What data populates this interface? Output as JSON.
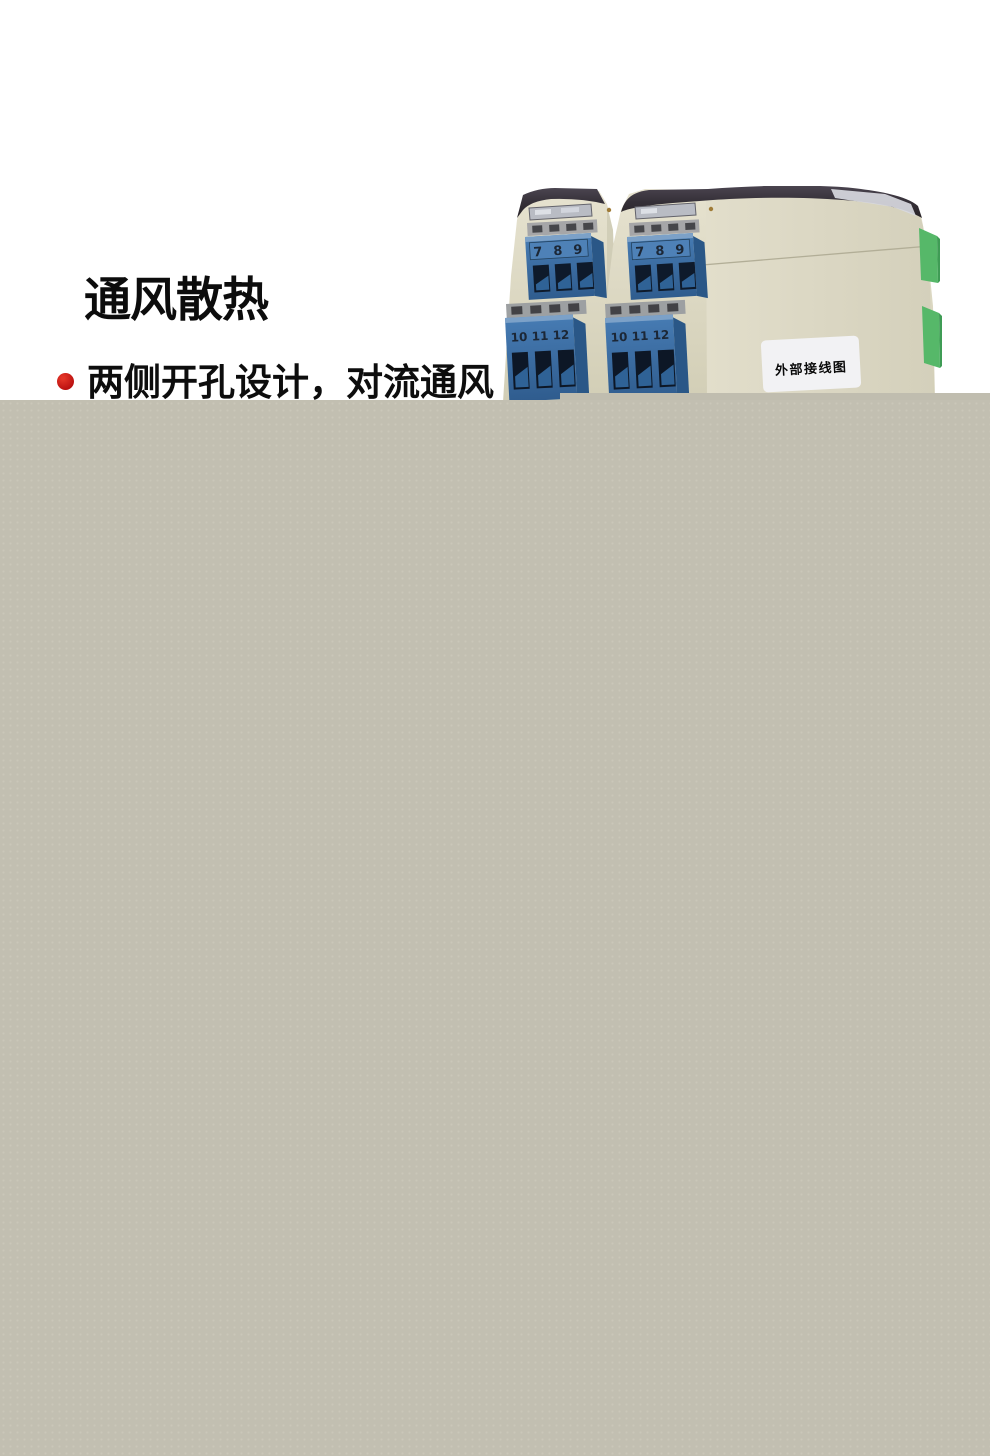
{
  "page": {
    "background": "#ffffff"
  },
  "section": {
    "title": "通风散热",
    "bullets": [
      {
        "text": "两侧开孔设计，对流通风"
      }
    ],
    "bullet_color": "#b90f0f",
    "text_color": "#0d0d0d"
  },
  "product_photo": {
    "wiring_label": "外部接线图",
    "terminal_numbers_top": [
      "7",
      "8",
      "9"
    ],
    "terminal_numbers_bottom": [
      "10",
      "11",
      "12"
    ],
    "colors": {
      "body_beige": "#dcd8c3",
      "terminal_blue": "#3a6ea8",
      "connector_green": "#56b869",
      "top_cover": "#353038",
      "label_bg": "#f2f2f4"
    }
  },
  "overlay_panel": {
    "color": "#c2bfb1"
  }
}
